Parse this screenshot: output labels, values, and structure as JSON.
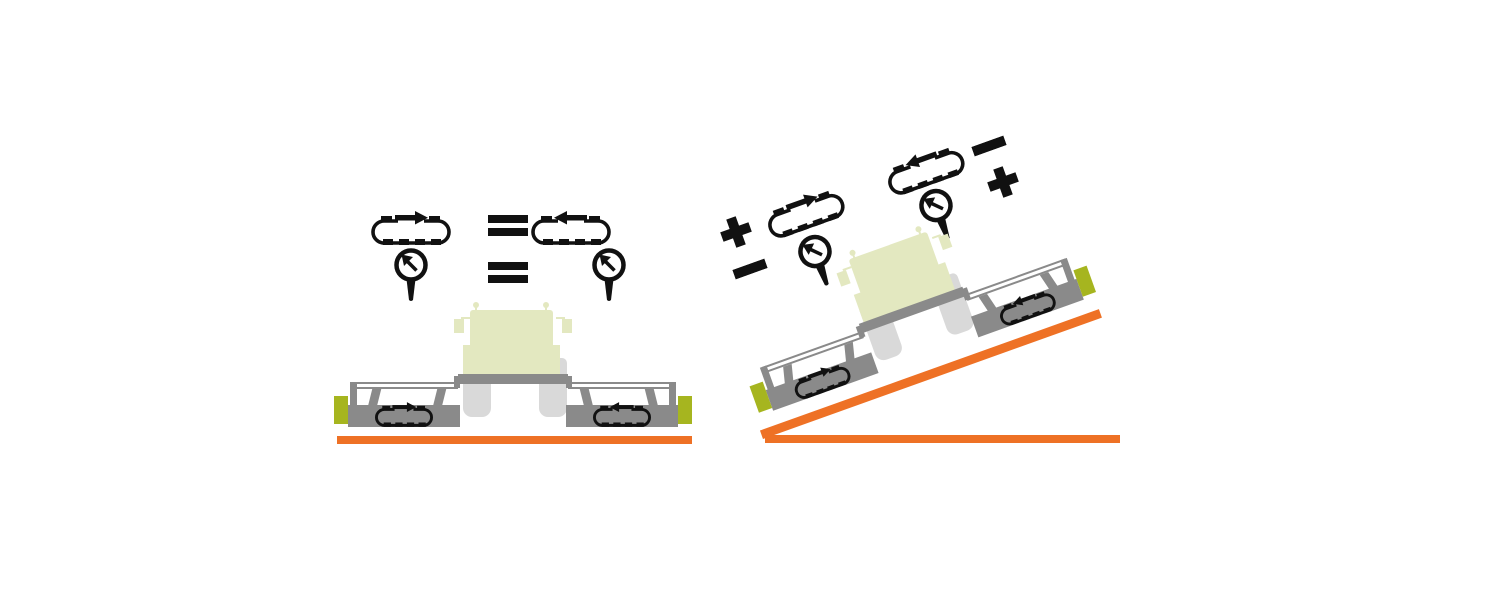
{
  "canvas": {
    "width": 1500,
    "height": 600,
    "background": "#ffffff"
  },
  "palette": {
    "ground_orange": "#EE7125",
    "end_plate_lime": "#A6B51F",
    "machine_body_green": "#E3E8C0",
    "machine_gray": "#8A8A8A",
    "tire_gray": "#D9D9D9",
    "icon_black": "#111111"
  },
  "flat_scene": {
    "name": "level-ground",
    "ground": "flat",
    "comparisons": [
      {
        "left_icon": "belt-arrow-right-icon",
        "operator": "=",
        "right_icon": "belt-arrow-left-icon"
      },
      {
        "left_icon": "gauge-icon",
        "operator": "=",
        "right_icon": "gauge-icon"
      }
    ],
    "equals_sign": "="
  },
  "slope_scene": {
    "name": "side-slope",
    "ground": "slope",
    "slope_angle_deg": 19.7,
    "downhill_side": {
      "belt_icon": "belt-arrow-right-icon",
      "belt_sign": "+",
      "gauge_icon": "gauge-icon",
      "gauge_sign": "−"
    },
    "uphill_side": {
      "belt_icon": "belt-arrow-left-icon",
      "belt_sign": "−",
      "gauge_icon": "gauge-icon",
      "gauge_sign": "+"
    }
  },
  "machine": {
    "parts": [
      "cab",
      "mirrors",
      "antennas",
      "tires",
      "center-toolbar",
      "side-rails",
      "support-struts",
      "roller-boxes",
      "belt-direction-icons",
      "end-plates"
    ],
    "left_roller_belt_direction": "right",
    "right_roller_belt_direction": "left"
  }
}
